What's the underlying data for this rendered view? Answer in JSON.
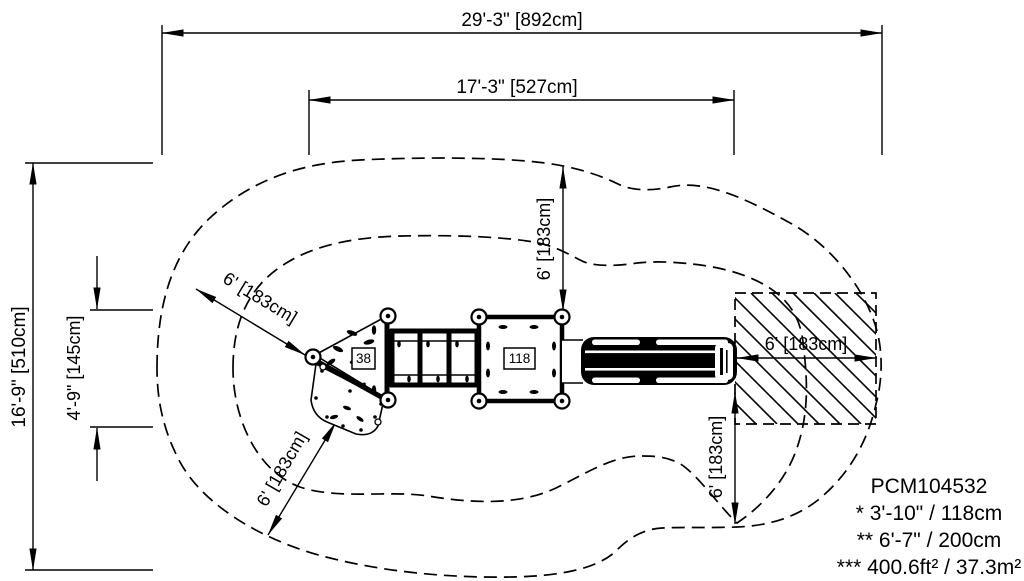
{
  "dimensions": {
    "overall_length": "29'-3\" [892cm]",
    "structure_length": "17'-3\" [527cm]",
    "overall_depth": "16'-9\" [510cm]",
    "deck_section_depth": "4'-9\" [145cm]",
    "use_zone_clearance": "6' [183cm]"
  },
  "equipment": {
    "deck_label_left": "38",
    "deck_label_right": "118"
  },
  "title_block": {
    "model_number": "PCM104532",
    "footnote_fall_height": "* 3'-10\" / 118cm",
    "footnote_deck_height": "** 6'-7\" / 200cm",
    "footnote_use_zone_area": "*** 400.6ft² / 37.3m²"
  },
  "colors": {
    "ink": "#000000",
    "paper": "#ffffff"
  }
}
